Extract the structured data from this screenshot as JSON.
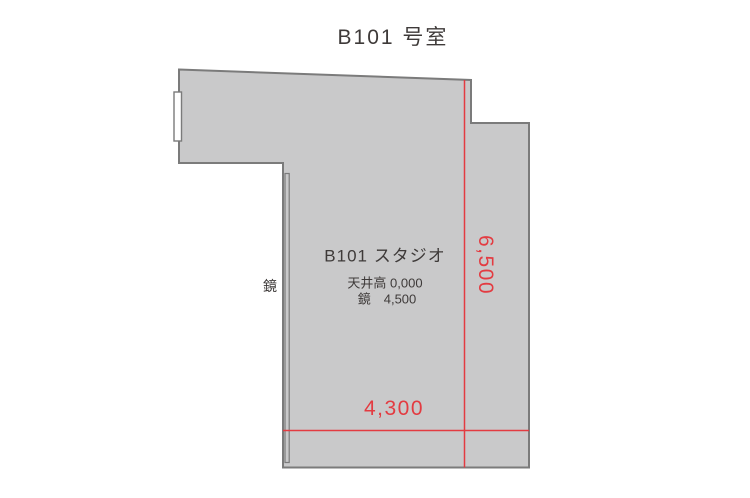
{
  "title": "B101 号室",
  "floor_plan": {
    "room_label": "B101 スタジオ",
    "ceiling_height_label": "天井高 0,000",
    "mirror_spec_label": "鏡　4,500",
    "mirror_side_label": "鏡",
    "dimensions": {
      "height_label": "6,500",
      "width_label": "4,300"
    },
    "colors": {
      "floor_fill": "#c9c9ca",
      "wall_stroke": "#7b7b7b",
      "dimension_red": "#e33b41",
      "text_dark": "#3e3a39",
      "background": "#ffffff"
    }
  }
}
